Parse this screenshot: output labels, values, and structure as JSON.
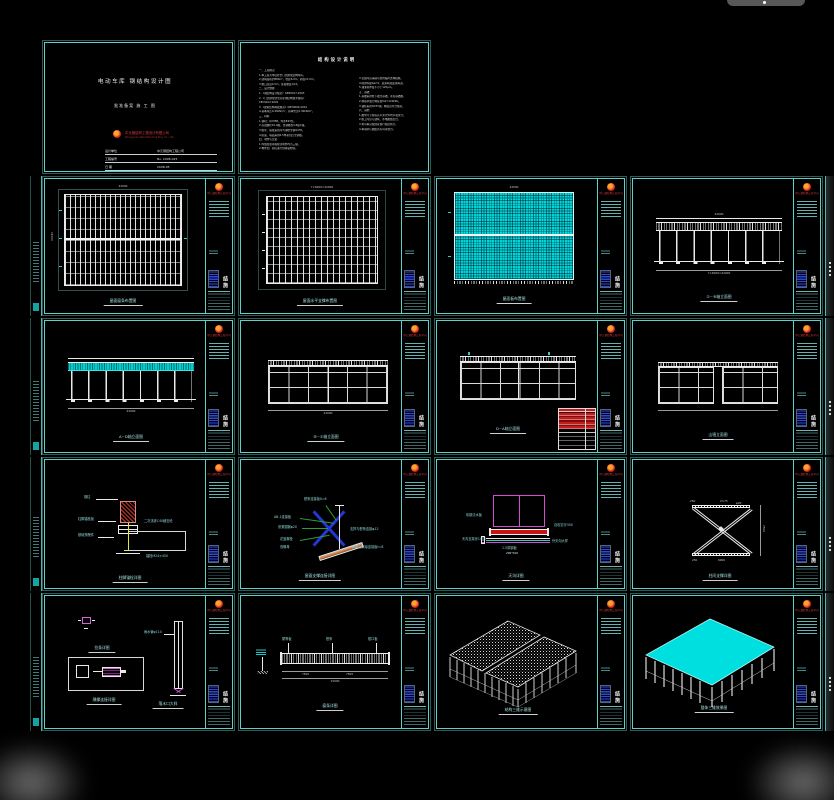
{
  "titleblock": {
    "sheet_no": "结施",
    "company": "中元钢结构工程公司"
  },
  "sheets": {
    "cover": {
      "title_main": "电动车库 钢结构设计图",
      "subtitle": "批准备案    施 工 图",
      "company": "中元钢结构工程设计有限公司",
      "company_en": "Zhongyuan Steel Structure Eng. Co., Ltd.",
      "rows": [
        {
          "label": "设计单位",
          "value": "中元钢结构工程公司"
        },
        {
          "label": "工程编号",
          "value": "No. 2008-025"
        },
        {
          "label": "日 期",
          "value": "2008-05"
        }
      ]
    },
    "notes": {
      "title": "结构设计说明",
      "left_lines": [
        "一、工程概况",
        "1.本工程为单层轻型门式刚架结构车库。",
        "2.建筑面积约880m²，柱距6.0m，跨度21.0m。",
        "3.檐口高度4.5m，屋面坡度1/10。",
        "二、设计依据",
        "1.《钢结构设计规范》GB50017-2003",
        "2.《门式刚架轻型房屋钢结构技术规程》",
        "   CECS102:2002",
        "3.《建筑结构荷载规范》GB50009-2001",
        "4.基本风压0.45kN/m²，基本雪压0.30kN/m²。",
        "三、材料",
        "1.钢材：Q235B，焊条E43型。",
        "2.高强螺栓10.9级，普通螺栓4.6级C级。",
        "3.檩条、墙梁采用冷弯薄壁型钢Q235。",
        "4.屋面、墙面采用0.5厚彩色压型钢板。",
        "四、制作与安装",
        "1.焊缝质量等级除注明外均为三级。",
        "2.构件出厂前应进行预拼装检验。"
      ],
      "right_lines": [
        "3.安装时应采取可靠的临时支撑措施。",
        "4.除锈等级Sa2.5，底漆两道面漆两道。",
        "5.油漆总厚度不小于125μm。",
        "五、基础",
        "1.基础采用柱下独立基础，详见基础图。",
        "2.地基承载力特征值fak=120kPa。",
        "3.锚栓采用Q235钢，精度应符合规范。",
        "六、其他",
        "1.图中尺寸除标高以米计外均以毫米计。",
        "2.施工时应与建筑、水电图纸配合。",
        "3.未尽事宜按国家现行规范执行。",
        "4.本说明与图纸具有同等效力。"
      ]
    },
    "r2s1": {
      "title": "屋面檩条布置图",
      "dim_top": "42000",
      "dim_left": "21000"
    },
    "r2s2": {
      "title": "屋面水平支撑布置图",
      "dim_top": "7×6000=42000"
    },
    "r2s3": {
      "title": "屋面板布置图",
      "dim_top": "42000"
    },
    "r2s4": {
      "title": "①~⑧轴立面图",
      "dim_top": "42000",
      "dim_bottom": "7×6000=42000"
    },
    "r3s1": {
      "title": "A~D轴立面图",
      "dim_bottom": "42000"
    },
    "r3s2": {
      "title": "⑧~①轴立面图",
      "dim_bottom": "42000"
    },
    "r3s3": {
      "title": "D~A轴立面图"
    },
    "r3s4": {
      "title": "山墙立面图"
    },
    "r4s1": {
      "title": "柱脚锚栓详图",
      "labels": {
        "l1": "钢柱",
        "l2": "柱脚锚栓板",
        "l3": "基础预埋件",
        "r1": "二次浇灌C40细石砼",
        "b1": "锚栓M24×450"
      }
    },
    "r4s2": {
      "title": "屋面支撑连接详图",
      "labels": {
        "t1": "檩条连接板δ=6",
        "l1": "AB-1连接板",
        "l2": "张紧圆钢φ20",
        "l3": "花篮螺栓",
        "l4": "双螺母",
        "r1": "支撑与檩条连接φ12",
        "r2": "斜梁上翼缘连接板t=8"
      }
    },
    "r4s3": {
      "title": "天沟详图",
      "labels": {
        "l1": "彩钢泛水板",
        "l2": "天沟支架@1000",
        "r1": "自攻钉@300",
        "r2": "外天沟大样",
        "c1": "1.5厚钢板",
        "c2": "200*100"
      }
    },
    "r4s4": {
      "title": "柱间支撑详图",
      "dims": {
        "d1": "250",
        "d2": "2×75",
        "d3": "φ20",
        "d4": "6000",
        "d5": "250",
        "d6": "2500"
      }
    },
    "r5s1": {
      "title1": "拉条详图",
      "title2": "隅撑连接详图",
      "label_pipe": "雨水管φ110",
      "title3": "落水口大样"
    },
    "r5s2": {
      "title": "檩条详图",
      "labels": {
        "t1": "屋脊板",
        "t2": "檩条",
        "t3": "檐口板"
      },
      "dims": {
        "d1": "7500",
        "d2": "7500",
        "d3": "15000"
      }
    },
    "r5s3": {
      "title": "结构三维示意图"
    },
    "r5s4": {
      "title": "整体三维效果图"
    }
  }
}
